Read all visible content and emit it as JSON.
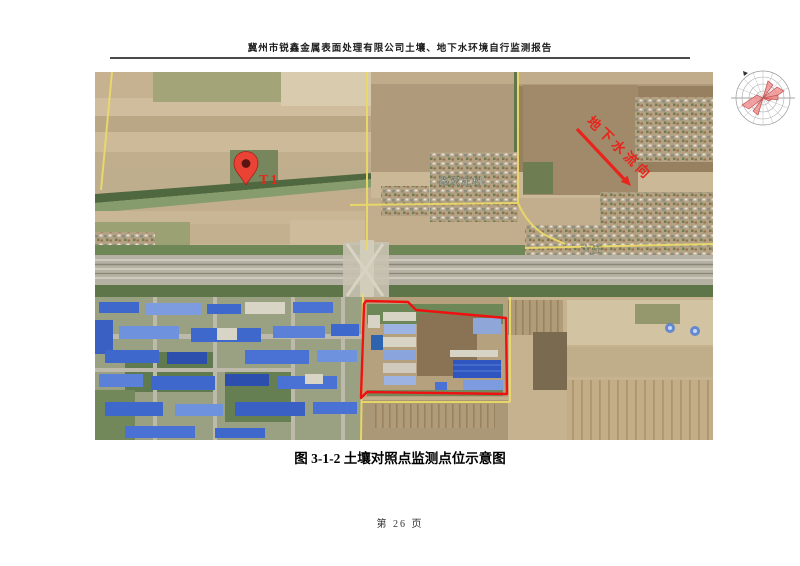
{
  "page": {
    "header_title": "冀州市锐鑫金属表面处理有限公司土壤、地下水环境自行监测报告",
    "figure_caption": "图 3-1-2  土壤对照点监测点位示意图",
    "page_number": "第 26 页"
  },
  "map": {
    "marker_label": "T1",
    "flow_label": "地下水流向",
    "village_labels": [
      "路家庄村",
      "大庄"
    ],
    "colors": {
      "annotation_red": "#e8251c",
      "pin_red": "#ea4335",
      "roof_blue": "#3e68cc",
      "road_yellow": "#ead969"
    }
  }
}
